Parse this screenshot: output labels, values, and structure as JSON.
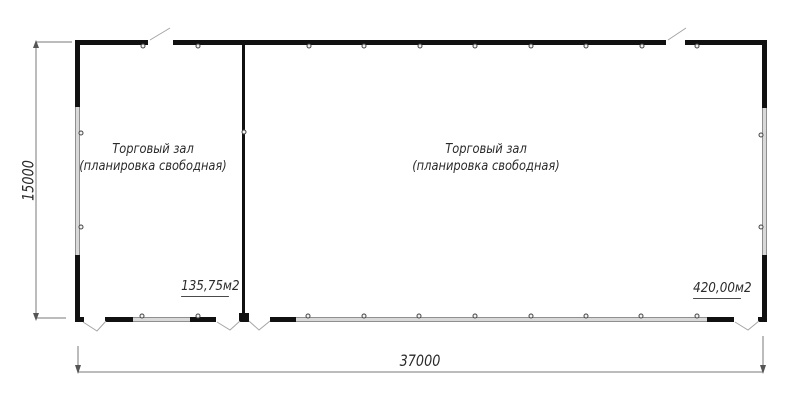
{
  "plan": {
    "title": "floor-plan",
    "rooms": [
      {
        "label": "Торговый зал",
        "sublabel": "(планировка свободная)",
        "area": "135,75м2"
      },
      {
        "label": "Торговый зал",
        "sublabel": "(планировка свободная)",
        "area": "420,00м2"
      }
    ],
    "dimensions": {
      "horizontal": "37000",
      "vertical": "15000"
    },
    "colors": {
      "wall": "#111111",
      "window_fill": "#d9d9d9",
      "window_edge": "#8f8f8f",
      "dimension_line": "#7a7a7a",
      "door_swing_line": "#a5a5a5",
      "tick_stroke": "#444444",
      "text": "#2b2b2b",
      "background": "#ffffff"
    }
  }
}
